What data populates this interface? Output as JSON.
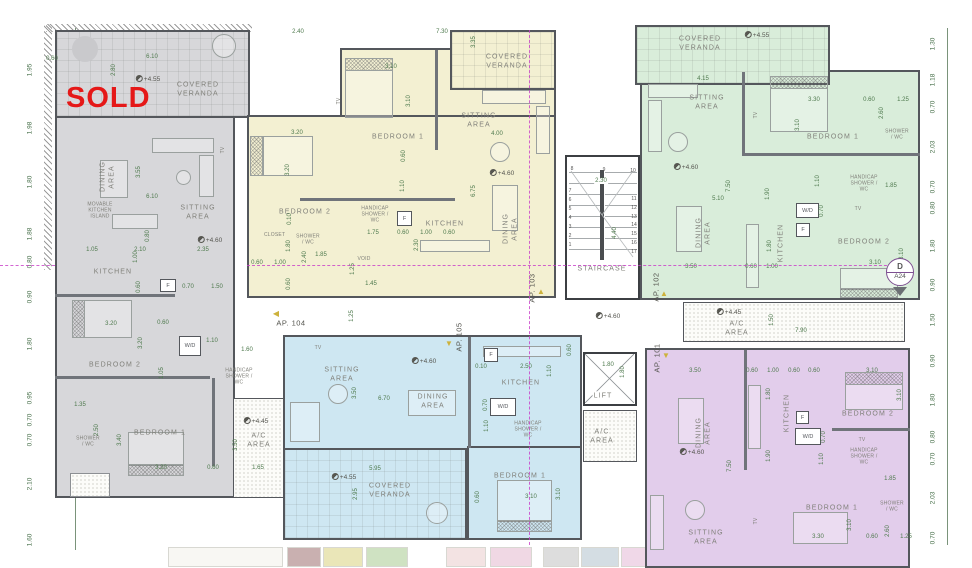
{
  "colors": {
    "unit_gray": "#d7d7da",
    "unit_yellow": "#f3f0d2",
    "unit_green": "#d9edda",
    "unit_blue": "#cee7f2",
    "unit_purple": "#e2cdeb",
    "wall": "#54575c",
    "dimension_text": "#4f7a4e",
    "room_label": "#80807a",
    "sold_red": "#e51818",
    "section_line": "#c93ec9",
    "entrance_arrow": "#cdb23c",
    "marker_purple": "#7d4f91",
    "thumbnails": [
      "#f8f7f3",
      "#c9b0b0",
      "#eae6b8",
      "#cfe2c2",
      "#f3e3e3",
      "#f0d8e4",
      "#dddddd",
      "#d4dde3",
      "#f0d8e8",
      "#e0e0dc",
      "#cfe4f0",
      "#f6f6f4"
    ]
  },
  "rails": {
    "left": [
      "1.95",
      "1.98",
      "1.80",
      "1.88",
      "0.80",
      "0.50",
      "0.90",
      "1.80",
      "0.95",
      "0.70",
      "0.70",
      "2.10",
      "1.60"
    ],
    "right": [
      "1.30",
      "1.18",
      "0.70",
      "2.03",
      "0.70",
      "0.80",
      "1.80",
      "0.90",
      "1.50",
      "0.90",
      "1.80",
      "0.80",
      "0.70",
      "2.03",
      "0.70"
    ]
  },
  "corridor": {
    "ap101": "AP. 101",
    "ap102": "AP. 102",
    "ap103": "AP. 103",
    "ap104": "AP. 104",
    "ap105": "AP. 105",
    "level": "+4.60",
    "dim": "1.25"
  },
  "stair": {
    "label": "STAIRCASE",
    "width": "2.30",
    "depth": "4.40",
    "steps": [
      "1",
      "2",
      "3",
      "4",
      "5",
      "6",
      "7",
      "8",
      "9",
      "10",
      "11",
      "12",
      "13",
      "14",
      "15",
      "16",
      "17"
    ]
  },
  "lift": {
    "label": "LIFT",
    "width": "1.80",
    "depth": "1.80"
  },
  "ac_mid": {
    "label": "A/C AREA"
  },
  "ac_right": {
    "label": "A/C AREA",
    "level": "+4.45",
    "height": "1.50",
    "width": "7.90"
  },
  "section_marker": {
    "letter": "D",
    "sheet": "A24"
  },
  "units": {
    "gray": {
      "status": "SOLD",
      "veranda": "COVERED VERANDA",
      "veranda_level": "+4.55",
      "dining": "DINING AREA",
      "sitting": "SITTING AREA",
      "level": "+4.60",
      "island": "MOVABLE KITCHEN ISLAND",
      "kitchen": "KITCHEN",
      "fridge": "F",
      "washer": "W/D",
      "bedroom2": "BEDROOM 2",
      "bedroom1": "BEDROOM 1",
      "handicap": "HANDICAP SHOWER / WC",
      "shower": "SHOWER / WC",
      "ac": "A/C AREA",
      "ac_level": "+4.45",
      "tv": "TV",
      "dims": [
        "0.60",
        "6.10",
        "2.80",
        "3.55",
        "6.10",
        "1.05",
        "2.10",
        "2.35",
        "1.00",
        "0.80",
        "0.70",
        "1.50",
        "3.20",
        "0.60",
        "3.20",
        "0.60",
        "1.10",
        "1.05",
        "1.60",
        "1.35",
        "2.50",
        "3.40",
        "3.20",
        "0.60",
        "3.50",
        "1.65"
      ]
    },
    "yellow": {
      "veranda": "COVERED VERANDA",
      "sitting": "SITTING AREA",
      "level": "+4.60",
      "bedroom1": "BEDROOM 1",
      "bedroom2": "BEDROOM 2",
      "closet": "CLOSET",
      "shower": "SHOWER / WC",
      "handicap": "HANDICAP SHOWER / WC",
      "void": "VOID",
      "kitchen": "KITCHEN",
      "fridge": "F",
      "dining": "DINING AREA",
      "tv": "TV",
      "dims": [
        "2.40",
        "7.30",
        "3.35",
        "3.10",
        "3.10",
        "0.60",
        "1.10",
        "3.20",
        "3.20",
        "4.00",
        "6.75",
        "1.75",
        "1.80",
        "2.40",
        "1.85",
        "0.60",
        "1.00",
        "0.60",
        "1.25",
        "1.45",
        "0.60",
        "1.00",
        "0.60",
        "2.30",
        "0.10"
      ]
    },
    "green": {
      "veranda": "COVERED VERANDA",
      "veranda_level": "+4.55",
      "sitting": "SITTING AREA",
      "level": "+4.60",
      "bedroom1": "BEDROOM 1",
      "bedroom2": "BEDROOM 2",
      "shower": "SHOWER / WC",
      "handicap": "HANDICAP SHOWER / WC",
      "washer": "W/D",
      "fridge": "F",
      "kitchen": "KITCHEN",
      "dining": "DINING AREA",
      "tv": "TV",
      "dims": [
        "4.15",
        "3.30",
        "3.10",
        "0.60",
        "1.25",
        "2.60",
        "7.50",
        "1.90",
        "1.10",
        "1.85",
        "5.10",
        "0.70",
        "1.80",
        "3.10",
        "3.10",
        "3.50",
        "0.60",
        "1.00"
      ]
    },
    "blue": {
      "sitting": "SITTING AREA",
      "level": "+4.60",
      "dining": "DINING AREA",
      "kitchen": "KITCHEN",
      "fridge": "F",
      "washer": "W/D",
      "handicap": "HANDICAP SHOWER / WC",
      "bedroom1": "BEDROOM 1",
      "veranda": "COVERED VERANDA",
      "veranda_level": "+4.55",
      "tv": "TV",
      "dims": [
        "3.50",
        "6.70",
        "0.10",
        "2.50",
        "0.60",
        "1.10",
        "0.70",
        "1.10",
        "0.60",
        "3.10",
        "3.10",
        "5.95",
        "2.95"
      ]
    },
    "purple": {
      "dining": "DINING AREA",
      "level": "+4.60",
      "kitchen": "KITCHEN",
      "fridge": "F",
      "washer": "W/D",
      "bedroom2": "BEDROOM 2",
      "handicap": "HANDICAP SHOWER / WC",
      "shower": "SHOWER / WC",
      "bedroom1": "BEDROOM 1",
      "sitting": "SITTING AREA",
      "tv": "TV",
      "dims": [
        "3.50",
        "0.60",
        "1.00",
        "0.60",
        "0.60",
        "3.10",
        "1.80",
        "1.90",
        "7.50",
        "0.70",
        "1.10",
        "3.10",
        "1.85",
        "3.30",
        "3.10",
        "0.60",
        "2.60",
        "1.25"
      ]
    }
  }
}
